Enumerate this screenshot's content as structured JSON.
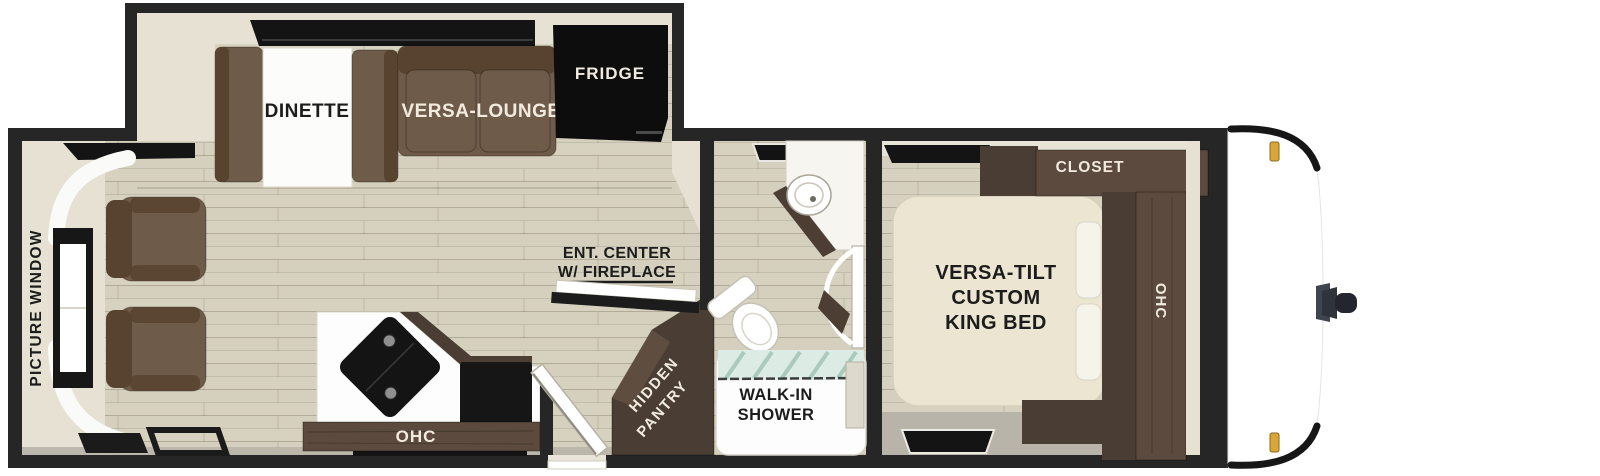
{
  "floorplan": {
    "labels": {
      "picture_window": "PICTURE WINDOW",
      "dinette": "DINETTE",
      "versa_lounge": "VERSA-LOUNGE",
      "fridge": "FRIDGE",
      "ent_center_line1": "ENT. CENTER",
      "ent_center_line2": "W/ FIREPLACE",
      "ohc_kitchen": "OHC",
      "hidden_pantry_line1": "HIDDEN",
      "hidden_pantry_line2": "PANTRY",
      "walk_in_shower_line1": "WALK-IN",
      "walk_in_shower_line2": "SHOWER",
      "king_bed_line1": "VERSA-TILT",
      "king_bed_line2": "CUSTOM",
      "king_bed_line3": "KING BED",
      "closet": "CLOSET",
      "ohc_bedroom": "OHC"
    },
    "colors": {
      "wall": "#262626",
      "beige": "#e6e1d3",
      "floor": "#d7d2c0",
      "gray_floor": "#b8b4a9",
      "brown": "#6f5b49",
      "brown_dark": "#57432f",
      "cabinet": "#5b4a3d",
      "cabinet_dark": "#4a3d33",
      "bed": "#ebe5d2",
      "counter": "#fdfdfd",
      "black": "#111111",
      "white": "#ffffff",
      "glass": "#dcebe3",
      "glass_streak": "#a9cabd",
      "gold": "#d9a738",
      "label_dark": "#1c1c1c",
      "label_light": "#f1ebdf"
    }
  }
}
